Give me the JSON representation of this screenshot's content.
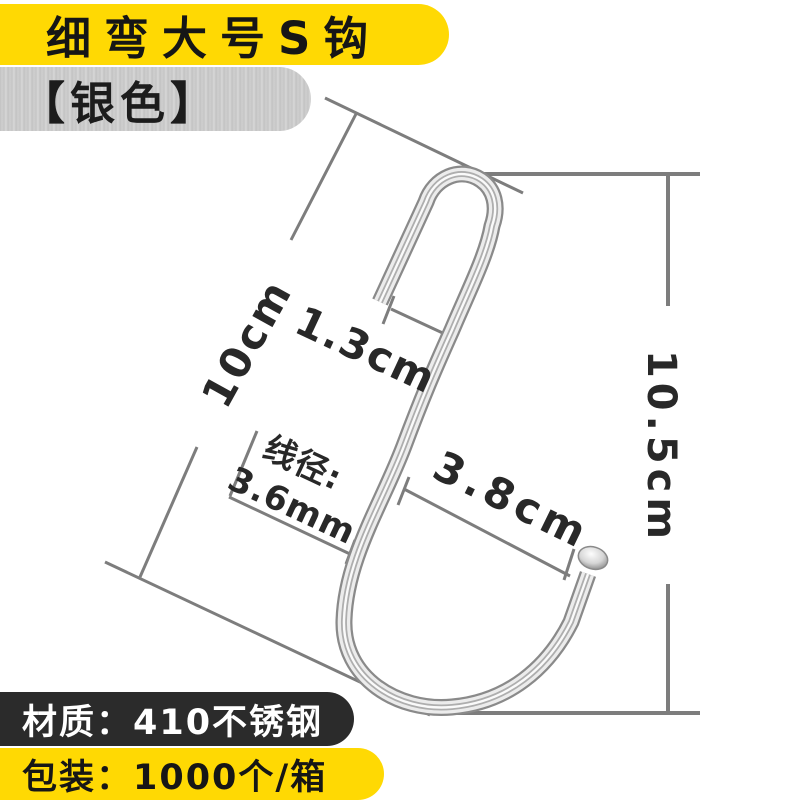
{
  "banners": {
    "title": "细弯大号S钩",
    "variant": "【银色】",
    "material": "材质：410不锈钢",
    "packaging": "包装：1000个/箱"
  },
  "dimensions": {
    "length": "10cm",
    "top_width": "1.3cm",
    "opening_width": "3.8cm",
    "wire_label": "线径:",
    "wire_value": "3.6mm",
    "total_height": "10.5cm"
  },
  "colors": {
    "accent-yellow": "#ffd903",
    "banner-black": "#2b2b2b",
    "silver-banner": "#c8c8c8",
    "line-gray": "#7d7d7d",
    "text-dark": "#282828",
    "text-light": "#ffffff",
    "hook-metal-light": "#ececec",
    "hook-metal-dark": "#8a8a8a"
  }
}
